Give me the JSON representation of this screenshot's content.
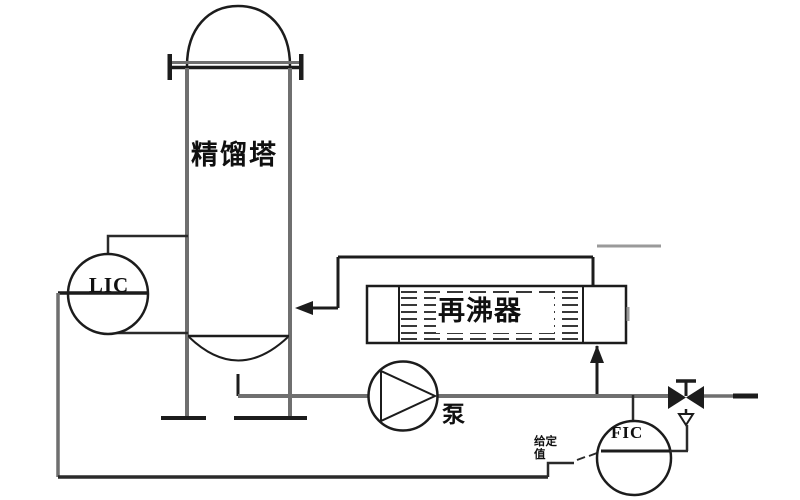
{
  "diagram": {
    "kind": "process-flow-diagram",
    "equipment": {
      "column_label": "精馏塔",
      "reboiler_label": "再沸器",
      "pump_label": "泵"
    },
    "instruments": {
      "level_controller_label": "LIC",
      "flow_controller_label": "FIC",
      "setpoint_label": "给定值"
    },
    "colors": {
      "equipment_line": "#1c1c1c",
      "pipe_line": "#6f6f6f",
      "signal_line": "#2a2a2a",
      "background": "#ffffff"
    }
  }
}
